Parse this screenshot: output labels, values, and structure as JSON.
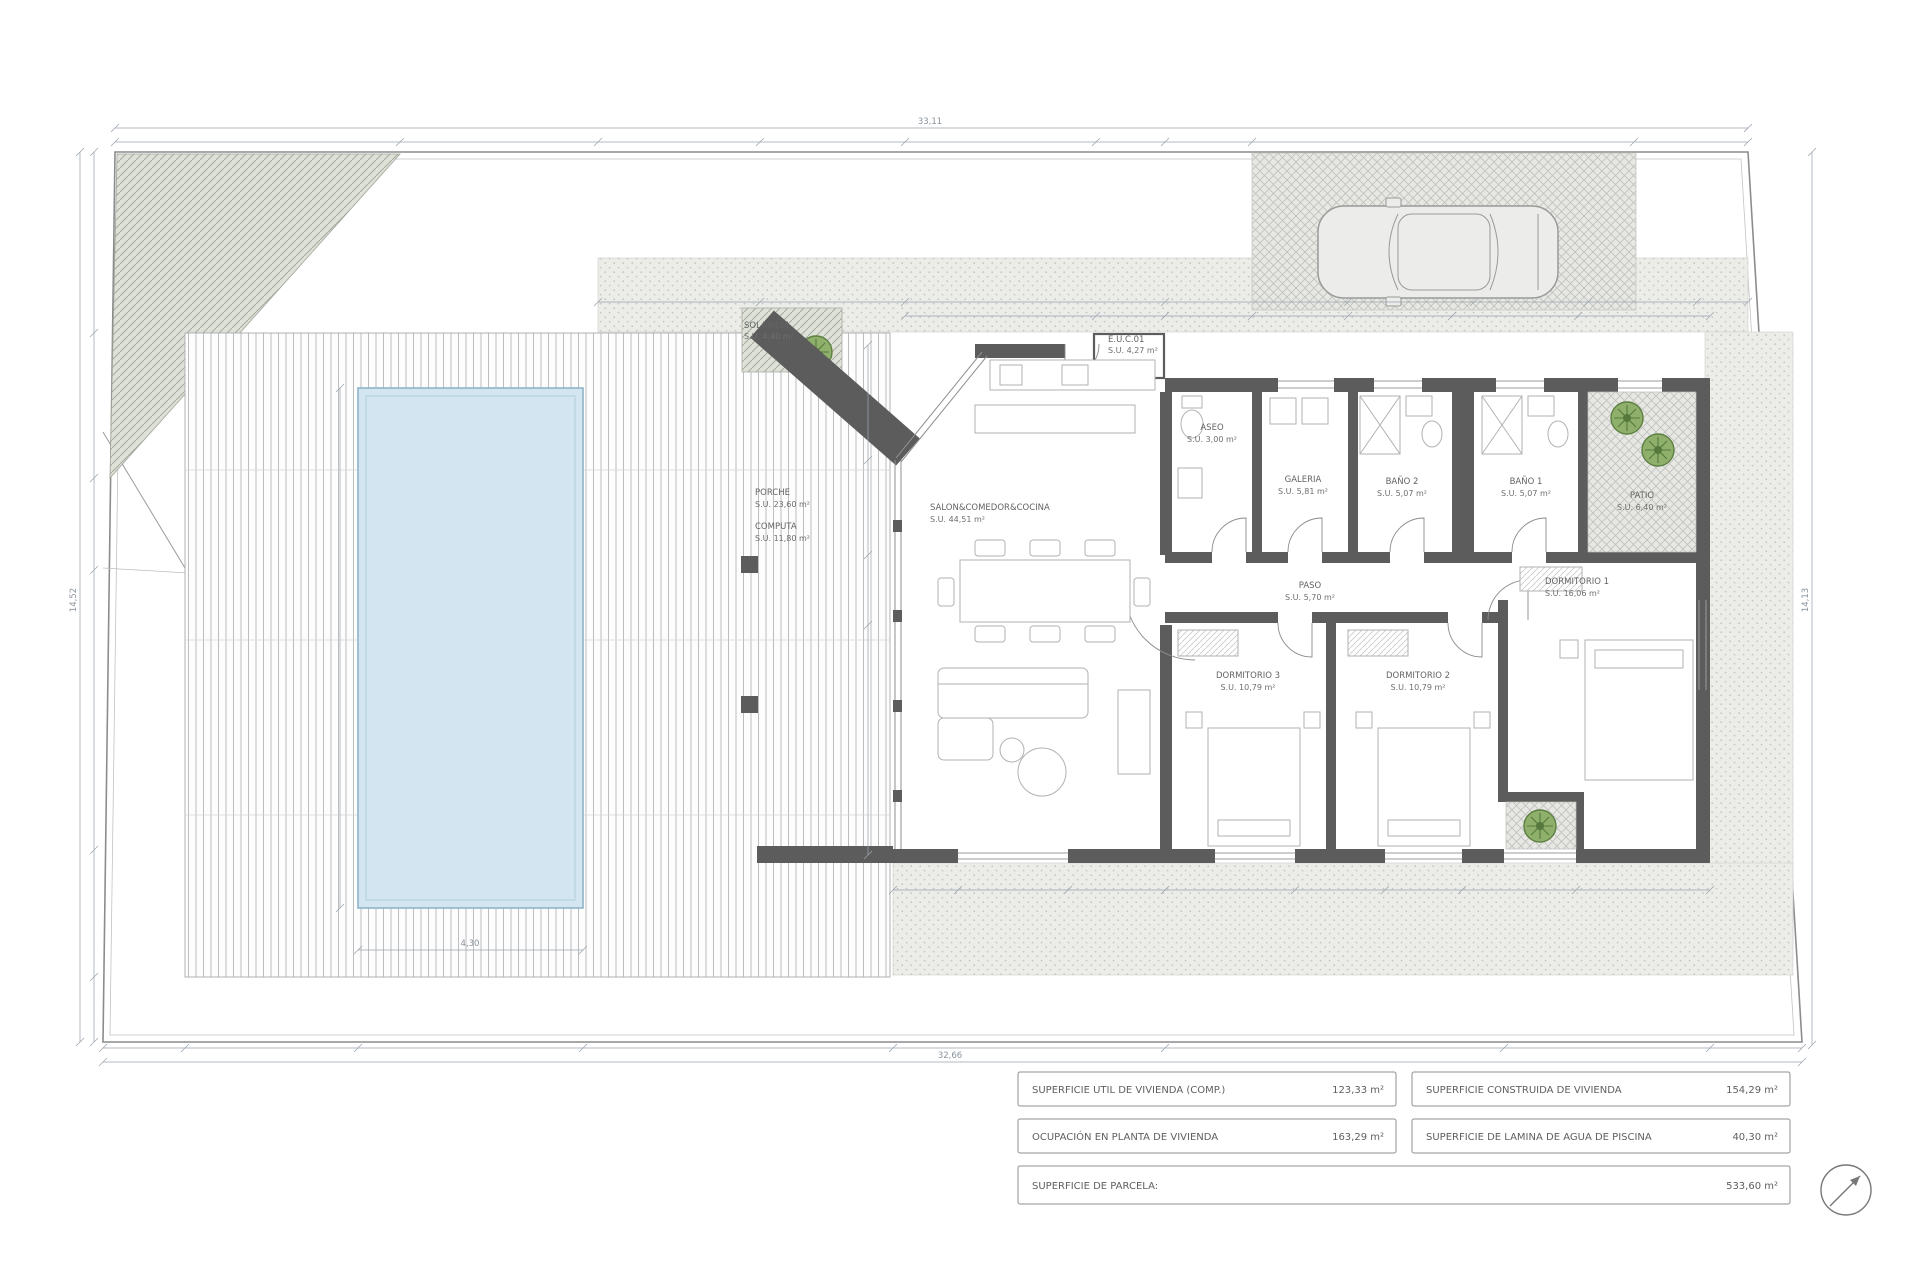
{
  "document": {
    "type": "architectural floor plan",
    "view": "planta vivienda unifamiliar con piscina"
  },
  "rooms": [
    {
      "name": "SALON&COMEDOR&COCINA",
      "area": "S.U. 44,51 m²"
    },
    {
      "name": "ASEO",
      "area": "S.U. 3,00 m²"
    },
    {
      "name": "GALERIA",
      "area": "S.U. 5,81 m²"
    },
    {
      "name": "BAÑO 2",
      "area": "S.U. 5,07 m²"
    },
    {
      "name": "BAÑO 1",
      "area": "S.U. 5,07 m²"
    },
    {
      "name": "PATIO",
      "area": "S.U. 6,40 m²"
    },
    {
      "name": "PASO",
      "area": "S.U. 5,70 m²"
    },
    {
      "name": "DORMITORIO 3",
      "area": "S.U. 10,79 m²"
    },
    {
      "name": "DORMITORIO 2",
      "area": "S.U. 10,79 m²"
    },
    {
      "name": "DORMITORIO 1",
      "area": "S.U. 16,06 m²"
    },
    {
      "name": "PORCHE",
      "area": "S.U. 23,60 m²"
    },
    {
      "name": "COMPUTA",
      "area": "S.U. 11,80 m²"
    },
    {
      "name": "SOLARIUM",
      "area": "S.U. 4,40 m²"
    },
    {
      "name": "E.U.C.01",
      "area": "S.U. 4,27 m²"
    }
  ],
  "dimensions": {
    "site_width_top": "33,11",
    "site_width_bottom": "32,66",
    "site_depth_left": "14,52",
    "site_depth_right": "14,13",
    "pool_width": "4,30"
  },
  "summary_table": {
    "rows": [
      {
        "label": "SUPERFICIE UTIL DE VIVIENDA (COMP.)",
        "value": "123,33 m²"
      },
      {
        "label": "SUPERFICIE CONSTRUIDA DE VIVIENDA",
        "value": "154,29 m²"
      },
      {
        "label": "OCUPACIÓN EN PLANTA DE VIVIENDA",
        "value": "163,29 m²"
      },
      {
        "label": "SUPERFICIE DE LAMINA DE AGUA DE PISCINA",
        "value": "40,30 m²"
      },
      {
        "label": "SUPERFICIE DE PARCELA:",
        "value": "533,60 m²"
      }
    ]
  },
  "colors": {
    "wall": "#5c5c5c",
    "pool_fill": "#d3e5f0",
    "pool_edge": "#8fb4c9",
    "plant_green": "#8fb06b",
    "plant_green_dark": "#55783d",
    "dim_line": "#9aa3ad",
    "hatch_bg": "#dde1d8"
  }
}
